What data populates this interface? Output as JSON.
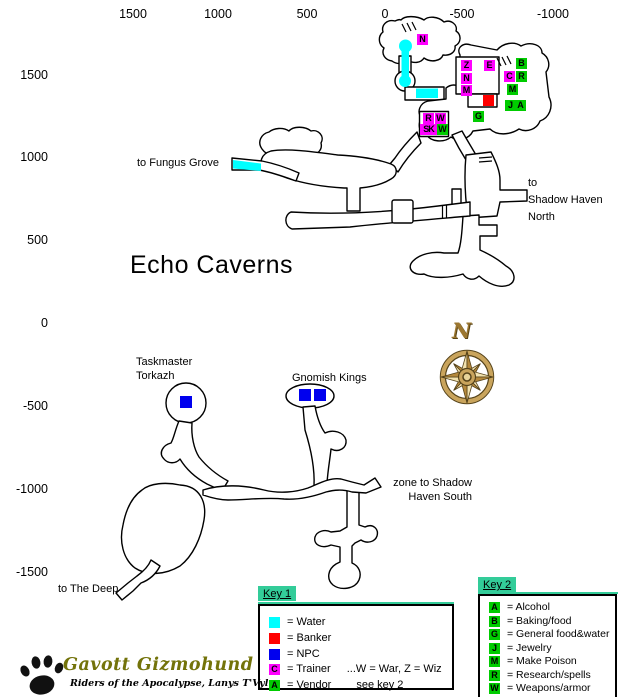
{
  "page_title": "Echo Caverns",
  "axis": {
    "top": [
      "1500",
      "1000",
      "500",
      "0",
      "-500",
      "-1000"
    ],
    "left": [
      "1500",
      "1000",
      "500",
      "0",
      "-500",
      "-1000",
      "-1500"
    ]
  },
  "labels": {
    "fungus_grove": "to Fungus Grove",
    "shadow_haven_north": [
      "to",
      "Shadow Haven",
      "North"
    ],
    "taskmaster": [
      "Taskmaster",
      "Torkazh"
    ],
    "gnomish_kings": "Gnomish Kings",
    "shadow_haven_south": [
      "zone to Shadow",
      "Haven South"
    ],
    "the_deep": "to The Deep"
  },
  "compass": {
    "north": "N"
  },
  "map_markers": {
    "n_top": "N",
    "z": "Z",
    "e": "E",
    "n_room": "N",
    "m_room": "M",
    "b": "B",
    "c": "C",
    "r": "R",
    "m": "M",
    "j": "J",
    "a": "A",
    "g": "G",
    "r2": "R",
    "w2": "W",
    "sk": "SK",
    "w3": "W"
  },
  "key1": {
    "title": "Key 1",
    "entries": [
      {
        "letter": "",
        "label": "= Water",
        "note": ""
      },
      {
        "letter": "",
        "label": "= Banker",
        "note": ""
      },
      {
        "letter": "",
        "label": "= NPC",
        "note": ""
      },
      {
        "letter": "C",
        "label": "= Trainer",
        "note": "...W = War, Z = Wiz"
      },
      {
        "letter": "A",
        "label": "= Vendor",
        "note": "see key 2"
      }
    ]
  },
  "key2": {
    "title": "Key 2",
    "entries": [
      {
        "letter": "A",
        "label": "= Alcohol"
      },
      {
        "letter": "B",
        "label": "= Baking/food"
      },
      {
        "letter": "G",
        "label": "= General food&water"
      },
      {
        "letter": "J",
        "label": "= Jewelry"
      },
      {
        "letter": "M",
        "label": "= Make Poison"
      },
      {
        "letter": "R",
        "label": "= Research/spells"
      },
      {
        "letter": "W",
        "label": "= Weapons/armor"
      }
    ]
  },
  "logo": {
    "name": "Gavott Gizmohund",
    "tagline": "Riders of the Apocalypse, Lanys T'Vyl"
  },
  "colors": {
    "water": "#00ffff",
    "banker": "#ff0000",
    "npc": "#0000ee",
    "trainer": "#ff00ff",
    "vendor": "#00cc00",
    "key-header": "#33cc99",
    "map-outline": "#000000",
    "compass-gold": "#c9a45c"
  }
}
